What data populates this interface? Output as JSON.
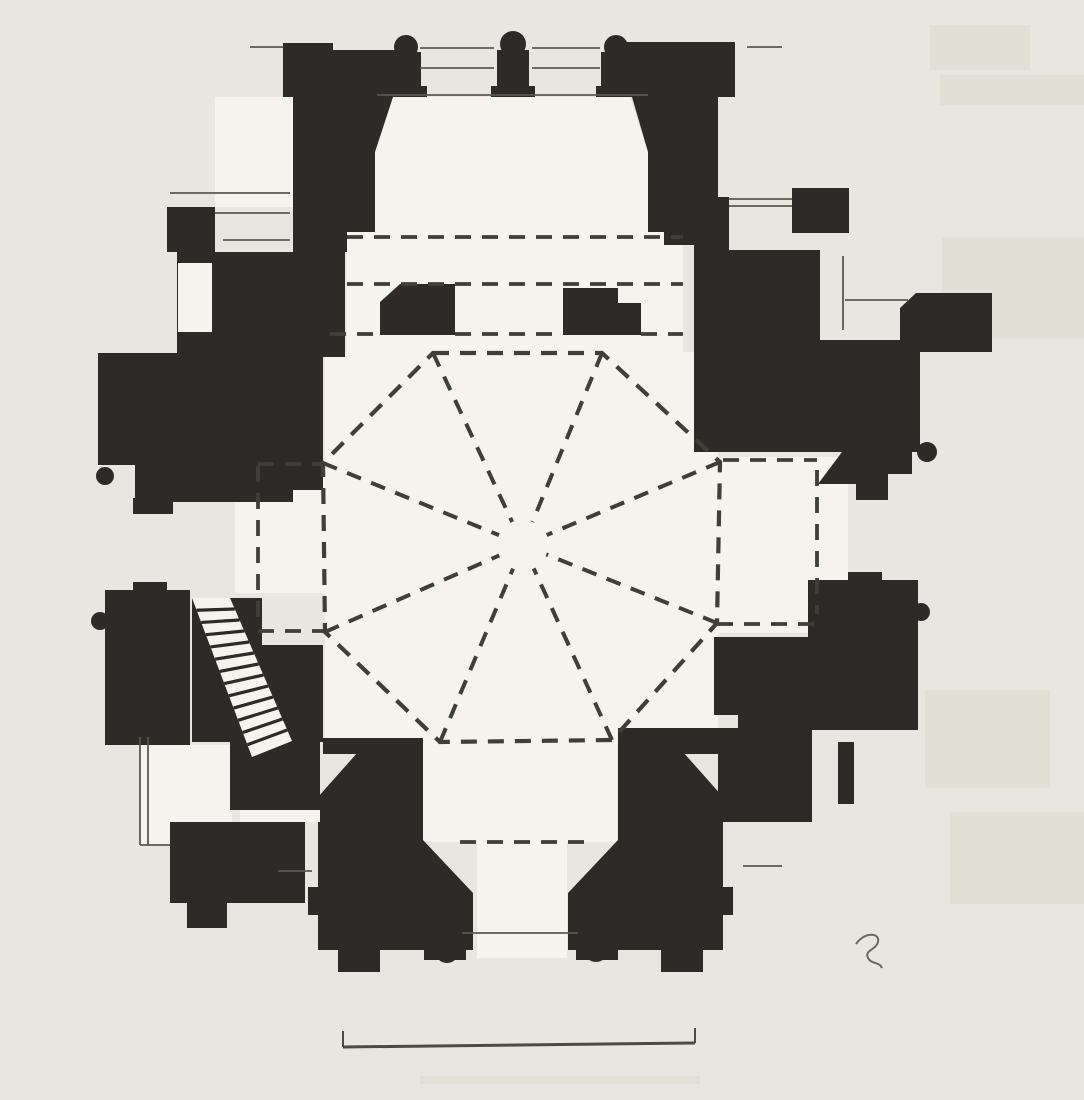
{
  "document": {
    "kind": "scanned architectural floor plan",
    "subject": "Gothic chapel plan with octagonal rib vault, hatched spiral stair, apse shafts and scale bar",
    "visible_text": ""
  },
  "colors": {
    "paper": "#e9e6e1",
    "interior": "#f5f3ee",
    "ink": "#2d2b28",
    "thin_line": "#5a564f",
    "dash_line": "#403e39",
    "scale_bar": "#4c4a45",
    "ghost": "#dcd8cf",
    "curl": "#6b6862"
  },
  "canvas": {
    "width": 1084,
    "height": 1100
  },
  "ghosts": [
    {
      "name": "ghost-patch-1",
      "rect": [
        930,
        25,
        100,
        45
      ]
    },
    {
      "name": "ghost-patch-2",
      "rect": [
        940,
        75,
        144,
        30
      ]
    },
    {
      "name": "ghost-patch-3",
      "rect": [
        942,
        238,
        142,
        100
      ]
    },
    {
      "name": "ghost-patch-4",
      "rect": [
        925,
        690,
        125,
        98
      ]
    },
    {
      "name": "ghost-patch-5",
      "rect": [
        950,
        812,
        134,
        92
      ]
    },
    {
      "name": "ghost-patch-6",
      "rect": [
        420,
        1076,
        280,
        8
      ]
    }
  ],
  "interiors": [
    {
      "name": "apse-interior",
      "poly": [
        393,
        97,
        630,
        97,
        648,
        152,
        648,
        232,
        375,
        232,
        375,
        152
      ]
    },
    {
      "name": "choir-interior",
      "rect": [
        347,
        232,
        336,
        122
      ]
    },
    {
      "name": "crossing-interior",
      "rect": [
        325,
        352,
        393,
        392
      ]
    },
    {
      "name": "west-bay-interior",
      "rect": [
        235,
        463,
        90,
        130
      ]
    },
    {
      "name": "east-bay-interior",
      "rect": [
        718,
        457,
        130,
        176
      ]
    },
    {
      "name": "south-bay-interior",
      "rect": [
        423,
        742,
        194,
        100
      ]
    },
    {
      "name": "portal-interior",
      "rect": [
        477,
        842,
        90,
        116
      ]
    },
    {
      "name": "northwest-bay-interior",
      "rect": [
        215,
        97,
        78,
        110
      ]
    },
    {
      "name": "northeast-bay-interior",
      "rect": [
        648,
        97,
        46,
        100
      ]
    },
    {
      "name": "southwest-bay-interior",
      "rect": [
        140,
        745,
        92,
        100
      ]
    }
  ],
  "masses": [
    {
      "name": "nw-choir-tower",
      "poly": [
        283,
        43,
        333,
        43,
        333,
        50,
        408,
        50,
        408,
        97,
        393,
        97,
        375,
        152,
        375,
        232,
        347,
        232,
        347,
        245,
        293,
        245,
        293,
        97,
        283,
        97
      ]
    },
    {
      "name": "ne-choir-tower",
      "poly": [
        610,
        42,
        735,
        42,
        735,
        97,
        718,
        97,
        718,
        245,
        664,
        245,
        664,
        232,
        648,
        232,
        648,
        152,
        632,
        97,
        610,
        97
      ]
    },
    {
      "name": "apse-shaft-1-cap",
      "circle": [
        406,
        47,
        12
      ]
    },
    {
      "name": "apse-shaft-1",
      "rect": [
        392,
        52,
        29,
        38
      ]
    },
    {
      "name": "apse-shaft-1-base",
      "rect": [
        386,
        86,
        41,
        11
      ]
    },
    {
      "name": "apse-shaft-2-cap",
      "circle": [
        513,
        44,
        13
      ]
    },
    {
      "name": "apse-shaft-2",
      "rect": [
        497,
        50,
        32,
        40
      ]
    },
    {
      "name": "apse-shaft-2-base",
      "rect": [
        491,
        86,
        44,
        11
      ]
    },
    {
      "name": "apse-shaft-3-cap",
      "circle": [
        616,
        47,
        12
      ]
    },
    {
      "name": "apse-shaft-3",
      "rect": [
        601,
        52,
        29,
        38
      ]
    },
    {
      "name": "apse-shaft-3-base",
      "rect": [
        596,
        86,
        41,
        11
      ]
    },
    {
      "name": "nw-crossing-pier",
      "poly": [
        400,
        284,
        455,
        284,
        455,
        335,
        380,
        335,
        380,
        302
      ]
    },
    {
      "name": "ne-crossing-pier",
      "poly": [
        563,
        288,
        618,
        288,
        618,
        303,
        641,
        303,
        641,
        335,
        563,
        335
      ]
    },
    {
      "name": "nw-chapel-buttress",
      "rect": [
        167,
        207,
        48,
        45
      ]
    },
    {
      "name": "nw-chapel-neck",
      "rect": [
        293,
        205,
        54,
        47
      ]
    },
    {
      "name": "nw-chapel-upper",
      "rect": [
        177,
        252,
        168,
        105
      ]
    },
    {
      "name": "nw-chapel-west",
      "rect": [
        98,
        353,
        82,
        112
      ]
    },
    {
      "name": "nw-chapel-lower",
      "rect": [
        180,
        357,
        143,
        133
      ]
    },
    {
      "name": "nw-chapel-foot",
      "rect": [
        135,
        462,
        158,
        40
      ]
    },
    {
      "name": "nw-chapel-foot-nub",
      "rect": [
        133,
        498,
        40,
        16
      ]
    },
    {
      "name": "nw-chapel-bulb",
      "circle": [
        105,
        476,
        9
      ]
    },
    {
      "name": "sw-chapel-block",
      "rect": [
        105,
        590,
        85,
        155
      ]
    },
    {
      "name": "sw-chapel-nub",
      "rect": [
        133,
        582,
        34,
        10
      ]
    },
    {
      "name": "sw-chapel-bulb",
      "circle": [
        100,
        621,
        9
      ]
    },
    {
      "name": "sw-stair-casing-top",
      "rect": [
        192,
        598,
        70,
        49
      ]
    },
    {
      "name": "sw-stair-casing",
      "rect": [
        192,
        645,
        131,
        97
      ]
    },
    {
      "name": "sw-ledge",
      "rect": [
        323,
        738,
        100,
        16
      ]
    },
    {
      "name": "sw-entrance-pier",
      "path": "M358,752 L423,752 L423,840 L473,893 L473,950 L318,950 L318,915 L308,915 L308,887 L318,887 L318,797 Z"
    },
    {
      "name": "sw-pier-foot-1",
      "rect": [
        338,
        946,
        42,
        26
      ]
    },
    {
      "name": "sw-pier-foot-2",
      "rect": [
        424,
        946,
        42,
        14
      ]
    },
    {
      "name": "sw-pier-bulb",
      "circle": [
        447,
        951,
        12
      ]
    },
    {
      "name": "sw-chapel-mid",
      "rect": [
        230,
        742,
        90,
        68
      ]
    },
    {
      "name": "sw-chapel-south",
      "rect": [
        170,
        822,
        135,
        81
      ]
    },
    {
      "name": "sw-chapel-south-foot",
      "rect": [
        187,
        900,
        40,
        28
      ]
    },
    {
      "name": "se-entrance-pier",
      "path": "M683,752 L618,752 L618,840 L568,893 L568,950 L723,950 L723,915 L733,915 L733,887 L723,887 L723,797 Z"
    },
    {
      "name": "se-pier-foot-1",
      "rect": [
        661,
        946,
        42,
        26
      ]
    },
    {
      "name": "se-pier-foot-2",
      "rect": [
        576,
        946,
        42,
        14
      ]
    },
    {
      "name": "se-pier-bulb",
      "circle": [
        596,
        950,
        12
      ]
    },
    {
      "name": "se-link",
      "rect": [
        618,
        728,
        120,
        26
      ]
    },
    {
      "name": "se-chapel-upper",
      "rect": [
        808,
        580,
        110,
        150
      ]
    },
    {
      "name": "se-chapel-nub",
      "rect": [
        848,
        572,
        34,
        10
      ]
    },
    {
      "name": "se-chapel-bulb",
      "circle": [
        921,
        612,
        9
      ]
    },
    {
      "name": "se-chapel-west",
      "rect": [
        714,
        637,
        98,
        78
      ]
    },
    {
      "name": "se-chapel-mid",
      "rect": [
        738,
        703,
        74,
        119
      ]
    },
    {
      "name": "se-chapel-wall",
      "rect": [
        838,
        742,
        16,
        62
      ]
    },
    {
      "name": "se-chapel-east",
      "rect": [
        718,
        752,
        94,
        70
      ]
    },
    {
      "name": "ne-chapel-neck",
      "rect": [
        694,
        197,
        35,
        56
      ]
    },
    {
      "name": "ne-chapel-buttress",
      "rect": [
        792,
        188,
        57,
        45
      ]
    },
    {
      "name": "ne-chapel-upper",
      "rect": [
        694,
        250,
        126,
        107
      ]
    },
    {
      "name": "ne-chapel-east",
      "rect": [
        820,
        340,
        100,
        112
      ]
    },
    {
      "name": "ne-chapel-lower",
      "rect": [
        694,
        357,
        126,
        95
      ]
    },
    {
      "name": "ne-chapel-outer",
      "poly": [
        916,
        293,
        992,
        293,
        992,
        352,
        900,
        352,
        900,
        308
      ]
    },
    {
      "name": "ne-chapel-wing",
      "poly": [
        818,
        484,
        842,
        452,
        912,
        452,
        912,
        474,
        888,
        474,
        888,
        500,
        856,
        500,
        856,
        484
      ]
    },
    {
      "name": "ne-chapel-bulb",
      "circle": [
        927,
        452,
        10
      ]
    }
  ],
  "cutouts": [
    {
      "name": "nw-chapel-window-recess",
      "rect": [
        178,
        263,
        34,
        69
      ]
    },
    {
      "name": "sw-chapel-slot",
      "rect": [
        240,
        810,
        80,
        12
      ]
    }
  ],
  "stair": {
    "name": "spiral-stair",
    "band": [
      192,
      598,
      230,
      598,
      292,
      741,
      252,
      757
    ],
    "steps": 12
  },
  "octagon": {
    "name": "vault-octagon",
    "center": [
      523,
      545
    ],
    "vertices": [
      [
        433,
        353
      ],
      [
        602,
        353
      ],
      [
        720,
        462
      ],
      [
        717,
        623
      ],
      [
        612,
        740
      ],
      [
        440,
        742
      ],
      [
        325,
        632
      ],
      [
        323,
        463
      ]
    ],
    "rib_inner_stop": 0.12
  },
  "dashed_lines": [
    {
      "name": "choir-vault-line-1",
      "seg": [
        347,
        237,
        683,
        237
      ]
    },
    {
      "name": "choir-vault-line-2",
      "seg": [
        347,
        284,
        683,
        284
      ]
    },
    {
      "name": "crossing-line-west",
      "seg": [
        330,
        334,
        380,
        334
      ]
    },
    {
      "name": "crossing-line-mid",
      "seg": [
        455,
        334,
        563,
        334
      ]
    },
    {
      "name": "crossing-line-east",
      "seg": [
        641,
        334,
        683,
        334
      ]
    },
    {
      "name": "west-bay-chord-north",
      "seg": [
        258,
        464,
        323,
        464
      ]
    },
    {
      "name": "east-bay-chord-north",
      "seg": [
        723,
        460,
        817,
        460
      ]
    },
    {
      "name": "west-bay-chord-south",
      "seg": [
        258,
        631,
        325,
        631
      ]
    },
    {
      "name": "east-bay-chord-south",
      "seg": [
        717,
        624,
        817,
        624
      ]
    },
    {
      "name": "portal-chord",
      "seg": [
        460,
        842,
        584,
        842
      ]
    },
    {
      "name": "west-bay-edge",
      "seg": [
        258,
        466,
        258,
        628
      ]
    },
    {
      "name": "east-bay-edge",
      "seg": [
        817,
        470,
        817,
        614
      ]
    }
  ],
  "thin_lines": [
    {
      "name": "apse-window-outer-1",
      "seg": [
        420,
        48,
        494,
        48
      ]
    },
    {
      "name": "apse-window-outer-2",
      "seg": [
        532,
        48,
        600,
        48
      ]
    },
    {
      "name": "apse-window-mid-1",
      "seg": [
        420,
        68,
        494,
        68
      ]
    },
    {
      "name": "apse-window-mid-2",
      "seg": [
        532,
        68,
        600,
        68
      ]
    },
    {
      "name": "apse-inner-face",
      "seg": [
        377,
        95,
        648,
        95
      ]
    },
    {
      "name": "apse-stub-left",
      "seg": [
        250,
        47,
        283,
        47
      ]
    },
    {
      "name": "apse-stub-right",
      "seg": [
        747,
        47,
        782,
        47
      ]
    },
    {
      "name": "nw-window-outer",
      "seg": [
        170,
        193,
        290,
        193
      ]
    },
    {
      "name": "nw-window-mid",
      "seg": [
        215,
        213,
        290,
        213
      ]
    },
    {
      "name": "nw-window-inner",
      "seg": [
        223,
        240,
        290,
        240
      ]
    },
    {
      "name": "ne-window-outer",
      "seg": [
        729,
        199,
        792,
        199
      ]
    },
    {
      "name": "ne-window-inner",
      "seg": [
        729,
        206,
        792,
        206
      ]
    },
    {
      "name": "ne-recess-edge",
      "seg": [
        843,
        256,
        843,
        330
      ]
    },
    {
      "name": "ne-recess-sill",
      "seg": [
        845,
        300,
        908,
        300
      ]
    },
    {
      "name": "sw-bay-edge-outer",
      "seg": [
        140,
        737,
        140,
        845
      ]
    },
    {
      "name": "sw-bay-edge-inner",
      "seg": [
        148,
        737,
        148,
        845
      ]
    },
    {
      "name": "sw-bay-sill",
      "seg": [
        140,
        845,
        170,
        845
      ]
    },
    {
      "name": "porch-line-left",
      "seg": [
        278,
        871,
        312,
        871
      ]
    },
    {
      "name": "porch-line-right",
      "seg": [
        743,
        866,
        782,
        866
      ]
    },
    {
      "name": "portal-step-line",
      "seg": [
        462,
        933,
        578,
        933
      ]
    }
  ],
  "scale_bar": {
    "name": "scale-bar",
    "line": [
      343,
      1047,
      695,
      1043
    ],
    "left_tick": [
      343,
      1031,
      343,
      1047
    ],
    "right_tick": [
      695,
      1028,
      695,
      1043
    ]
  },
  "curl_mark": {
    "name": "paper-curl-mark",
    "path": "M856,944 C864,932 880,932 878,942 C876,950 864,950 868,958 C871,964 880,962 882,968"
  }
}
